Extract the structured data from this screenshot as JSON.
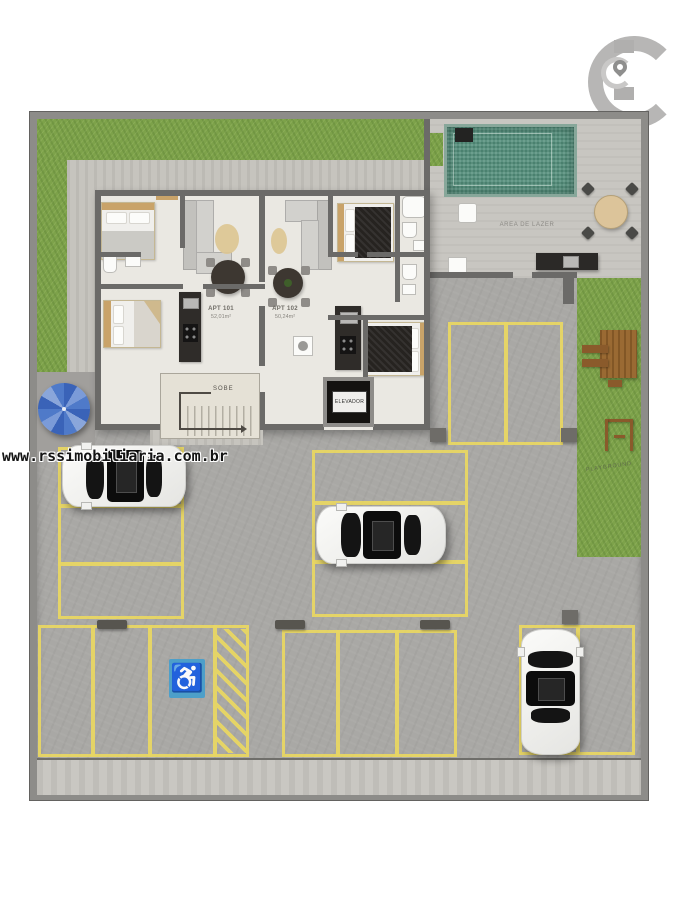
{
  "watermark": "www.rssimobiliaria.com.br",
  "logo": {
    "icon": "brand-c-location-pin"
  },
  "plan": {
    "leisure_label": "AREA DE LAZER",
    "apartments": [
      {
        "name": "APT 101",
        "area": "52,01m²"
      },
      {
        "name": "APT 102",
        "area": "50,24m²"
      }
    ],
    "stairs_label": "SOBE",
    "elevator_label": "ELEVADOR",
    "playground_label": "PLAYGROUND",
    "handicap_icon": "♿"
  },
  "colors": {
    "parking_line": "#e8d663",
    "grass": "#7da24a",
    "pool": "#55917d",
    "handicap_blue": "#4d9fc9",
    "concrete": "#a9a8a5",
    "wall": "#6b6a68",
    "leisure_paving": "#c8c6c1",
    "wood": "#9a6a33"
  }
}
